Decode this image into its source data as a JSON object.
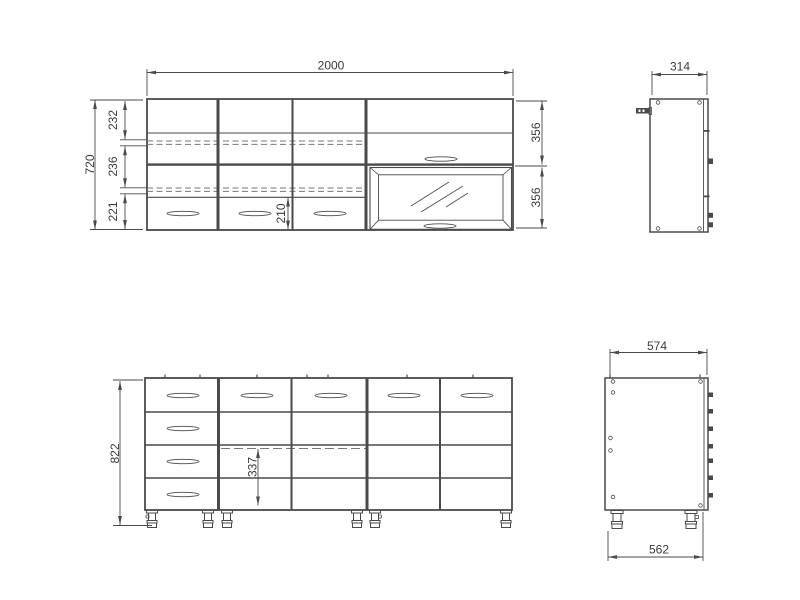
{
  "title": "kitchen-cabinet-technical-drawing",
  "colors": {
    "line": "#4a4a4a",
    "dim_text": "#3a3a3a",
    "dashed": "#777777",
    "background": "#ffffff"
  },
  "views": {
    "wall_front": {
      "width_label": "2000",
      "height_label": "720",
      "section_labels": [
        "232",
        "236",
        "221"
      ],
      "drawer_height_label": "210",
      "door_labels": [
        "356",
        "356"
      ]
    },
    "wall_side": {
      "depth_label": "314"
    },
    "base_front": {
      "height_label": "822",
      "shelf_height_label": "337"
    },
    "base_side": {
      "top_depth_label": "574",
      "bottom_depth_label": "562"
    }
  }
}
